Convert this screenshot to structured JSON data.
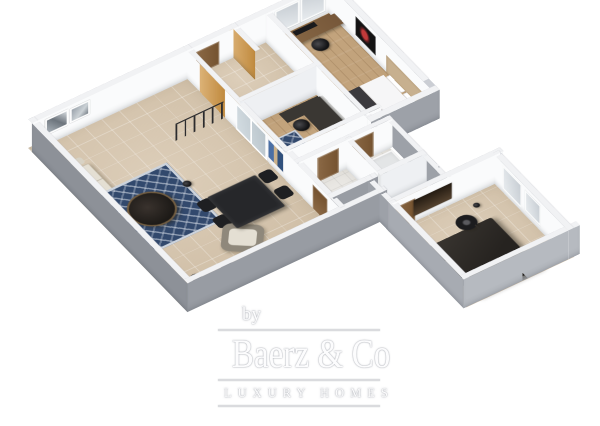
{
  "watermark": {
    "prefix": "by",
    "brand": "Baerz & Co",
    "tagline": "LUXURY HOMES"
  },
  "palette": {
    "bg": "#ffffff",
    "extW": "#8d9198",
    "extS": "#989ca3",
    "extLight": "#cbced4",
    "extNotch": "#9da1a8",
    "wingW": "#a7abb2",
    "wingS": "#b6bac0",
    "wallTop": "#f1f2f4",
    "wallInt": "#fafbfc",
    "wallIntDim": "#eef0f3",
    "tile": "#d7c6ae",
    "wood": "#c2a37c",
    "bathTile": "#e9e7e3",
    "yellow": "#dcb277",
    "yellowDeep": "#c08a3e",
    "rugBlue": "#32496d",
    "rugEdge": "#ccd3dc",
    "sofa": "#d8d2c4",
    "sofaSeat": "#e4dfd3",
    "tableDark": "#26272a",
    "chairDark": "#1e1f22",
    "woodFurn": "#8a6a47",
    "deskDark": "#3a3733",
    "bedWhite": "#f6f6f7",
    "bedThrow": "#3b3a3e",
    "headboard": "#c7b08f",
    "bed2Dark": "#2e2b28",
    "doorWood": "#8b6946",
    "cribTeal": "#4ab5c2",
    "artRed": "#c13a3a",
    "wmText": "#fcfcfd",
    "wmLine": "#dadbde"
  },
  "floorplan": {
    "view": "3d-axonometric-floor-plan",
    "rooms": [
      {
        "name": "living-dining-room",
        "floor": "beige-tile",
        "furniture": [
          "corner-sofa",
          "blue-pattern-rug",
          "round-coffee-table",
          "armchair",
          "dining-table",
          "dining-chairs-x4",
          "floor-lamps",
          "framed-pictures-x2",
          "blue-wall-art",
          "railing"
        ]
      },
      {
        "name": "entry-hall",
        "floor": "beige-tile",
        "features": [
          "yellow-accent-wall",
          "yellow-pillar",
          "front-door"
        ]
      },
      {
        "name": "study",
        "floor": "wood",
        "furniture": [
          "desk",
          "office-chair",
          "blue-rug",
          "teal-bassinet",
          "french-doors"
        ]
      },
      {
        "name": "bedroom-1",
        "floor": "wood",
        "furniture": [
          "desk",
          "monitor",
          "office-chair",
          "dresser",
          "double-bed",
          "nightstand",
          "red-flower-artwork",
          "windows-x2"
        ]
      },
      {
        "name": "hallway",
        "floor": "beige-tile",
        "furniture": [
          "wooden-doors",
          "floor-lamp"
        ]
      },
      {
        "name": "bathroom",
        "floor": "light-tile",
        "furniture": [
          "vanity-sink",
          "toilet",
          "wooden-door"
        ]
      },
      {
        "name": "shower-room",
        "floor": "light-tile",
        "furniture": [
          "shower-tray"
        ]
      },
      {
        "name": "bedroom-2",
        "floor": "beige-tile",
        "furniture": [
          "double-bed",
          "round-fan",
          "dark-wall-niche",
          "windows-x2"
        ]
      }
    ]
  }
}
